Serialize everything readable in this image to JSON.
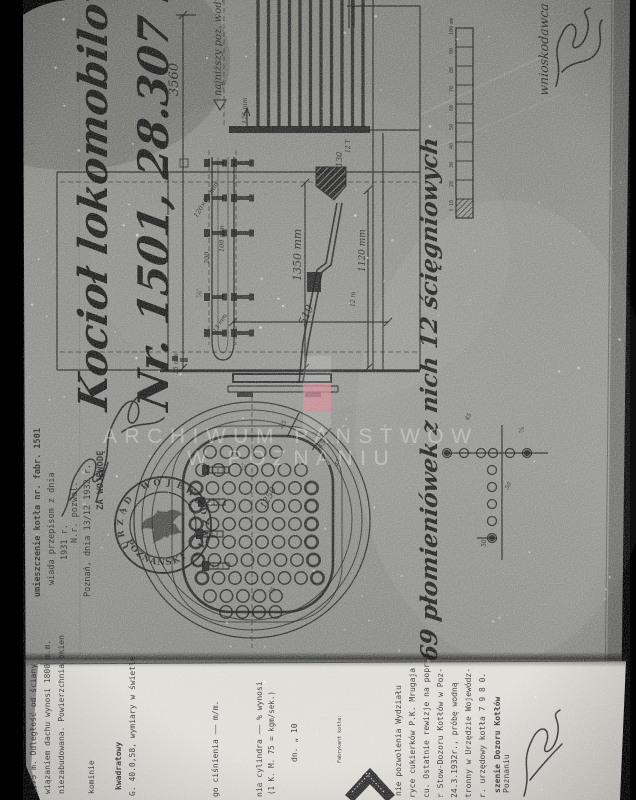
{
  "document": {
    "kind": "scanned archival boiler drawing",
    "language": "Polish",
    "title_line1": "Kocioł lokomobilowy z wycię",
    "title_line2": "Nr. 1501, 28.307 m² pow",
    "tube_note": "69 płomieniówek z nich 12 ścięgniowych",
    "applicant_label": "wnioskodawca",
    "watermark_line1": "ARCHIWUM PAŃSTWOW",
    "watermark_line2": "W POZNANIU"
  },
  "colors": {
    "scanner_bg": "#000000",
    "paper_grey": "#8f8f8d",
    "paper_white": "#e2e0da",
    "ink": "#1d1d1d",
    "watermark_white": "#ffffff",
    "marker_pink": "#d9818d"
  },
  "side_view": {
    "tubes": {
      "count": 11,
      "x0": 258,
      "pitch": 10.5,
      "y_top": 0,
      "y_bottom": 127
    },
    "stay_bolt_rows": [
      163,
      198,
      233,
      297,
      333
    ],
    "labels": [
      [
        "3560",
        178,
        96,
        13
      ],
      [
        "najniższy poz. wody",
        221,
        96,
        10
      ],
      [
        "125 mm",
        247,
        124,
        6.5
      ],
      [
        "120×32 mm",
        197,
        218,
        6.5,
        -58
      ],
      [
        "100 mm",
        224,
        252,
        6.5
      ],
      [
        "200",
        209,
        264,
        6.5
      ],
      [
        "⅞″",
        202,
        298,
        7
      ],
      [
        "13 mm",
        216,
        333,
        6,
        -58
      ],
      [
        "15 mm",
        178,
        374,
        6
      ],
      [
        "1350 mm",
        301,
        281,
        11
      ],
      [
        "1120 mm",
        365,
        272,
        9
      ],
      [
        "519",
        305,
        326,
        11,
        -65
      ],
      [
        "130",
        342,
        167,
        8
      ],
      [
        "12 T",
        350,
        153,
        6
      ],
      [
        "12 m",
        355,
        307,
        6
      ]
    ]
  },
  "tube_sheet": {
    "hole_radius": 6.2,
    "pitch": 16.5,
    "rows": [
      {
        "y": 452,
        "x0": 210,
        "n": 5
      },
      {
        "y": 470,
        "x0": 202,
        "n": 7
      },
      {
        "y": 488,
        "x0": 196,
        "n": 8
      },
      {
        "y": 506,
        "x0": 196,
        "n": 8
      },
      {
        "y": 524,
        "x0": 196,
        "n": 8
      },
      {
        "y": 542,
        "x0": 196,
        "n": 8
      },
      {
        "y": 560,
        "x0": 198,
        "n": 8
      },
      {
        "y": 578,
        "x0": 202,
        "n": 8
      },
      {
        "y": 596,
        "x0": 210,
        "n": 5
      },
      {
        "y": 612,
        "x0": 226,
        "n": 4
      }
    ],
    "bolts": [
      [
        210,
        470
      ],
      [
        206,
        502
      ],
      [
        204,
        534
      ],
      [
        210,
        566
      ]
    ],
    "labels": [
      [
        "25",
        282,
        429,
        6.5,
        -55
      ],
      [
        "45",
        321,
        449,
        6.5,
        -55
      ],
      [
        "45",
        337,
        467,
        6,
        -55
      ],
      [
        "1250",
        265,
        509,
        9,
        -60
      ],
      [
        "75",
        272,
        595,
        6,
        -60
      ],
      [
        "⅞″",
        247,
        471,
        6
      ]
    ]
  },
  "pitch_detail": {
    "r": 4.5,
    "row_y": 453,
    "row_x": [
      447,
      464,
      481,
      493,
      510,
      527
    ],
    "col_x": 492,
    "col_y": [
      470,
      487,
      504,
      521,
      538
    ],
    "filled": [
      [
        447,
        453
      ],
      [
        527,
        453
      ],
      [
        492,
        538
      ]
    ],
    "labels": [
      [
        "45",
        468,
        421,
        6,
        -60
      ],
      [
        "50",
        508,
        490,
        6,
        -60
      ],
      [
        "50",
        486,
        547,
        6,
        -90
      ],
      [
        "⅞",
        524,
        433,
        6,
        -90
      ]
    ]
  },
  "scale_bar": {
    "x": 456,
    "width": 17,
    "y_bottom": 218,
    "y_top": 28,
    "segments": 10,
    "unit": "mm",
    "tick_labels": [
      "10",
      "20",
      "30",
      "40",
      "50",
      "60",
      "70",
      "80",
      "90",
      "100"
    ],
    "half_label": "5"
  },
  "stamp": {
    "text_top": "URZĄD WOJEWÓDZKI",
    "text_bottom": "POZNAŃSKI",
    "separator": "*",
    "emblem": "eagle"
  },
  "approval_block": {
    "lines": [
      {
        "x": 40,
        "y": 597,
        "t": "umieszczenie kotła nr. fabr. 1501",
        "s": 8.5,
        "b": 1
      },
      {
        "x": 54,
        "y": 585,
        "t": "wiada przepisom z dnia",
        "s": 8.5
      },
      {
        "x": 67,
        "y": 560,
        "t": "1931 r.",
        "s": 8.5
      },
      {
        "x": 77,
        "y": 543,
        "t": "N.r. pozwol.",
        "s": 8.5
      },
      {
        "x": 90,
        "y": 597,
        "t": "Poznań, dnia 13/12 1932 r.",
        "s": 8.5
      },
      {
        "x": 103,
        "y": 510,
        "t": "ZA WOJEWODĘ",
        "s": 9,
        "b": 1
      }
    ]
  },
  "form": {
    "lines": [
      {
        "x": 36,
        "y": 794,
        "t": "3,75 m. Odległość od ściany",
        "s": 8
      },
      {
        "x": 50,
        "y": 794,
        "t": "wiązaniem dachu wynosi 1800 m.m.",
        "s": 8
      },
      {
        "x": 64,
        "y": 794,
        "t": "niezabudowana. Powierzchnia okien",
        "s": 8
      },
      {
        "x": 94,
        "y": 794,
        "t": "kominie",
        "s": 8
      },
      {
        "x": 121,
        "y": 790,
        "t": "kwadratowy",
        "s": 8,
        "b": 1
      },
      {
        "x": 135,
        "y": 796,
        "t": "G. 40.0,58, wymiary w świetle",
        "s": 8
      },
      {
        "x": 218,
        "y": 797,
        "t": "go ciśnienia —— m/m.",
        "s": 8
      },
      {
        "x": 262,
        "y": 797,
        "t": "nia cylindra —— % wynosi",
        "s": 8
      },
      {
        "x": 274,
        "y": 795,
        "t": "(1 K. M. 75 = kgm/sek.)",
        "s": 7.5
      },
      {
        "x": 297,
        "y": 762,
        "t": "dn. „ 10",
        "s": 8
      },
      {
        "x": 341,
        "y": 763,
        "t": "Fabrykant kotła:",
        "s": 5
      },
      {
        "x": 401,
        "y": 796,
        "t": "nie pozwolenia Wydziału",
        "s": 8
      },
      {
        "x": 415,
        "y": 798,
        "t": "ryce cukierków P.K. Mrugaja",
        "s": 8
      },
      {
        "x": 429,
        "y": 798,
        "t": "cu. Ostatnie rewizje na poprze",
        "s": 8
      },
      {
        "x": 443,
        "y": 798,
        "t": "r Stow-Dozoru Kotłów w Poz-",
        "s": 8
      },
      {
        "x": 457,
        "y": 798,
        "t": "24.3.1932r., próbę wodną",
        "s": 8
      },
      {
        "x": 471,
        "y": 798,
        "t": "tronny w Urzędzie Wojewódz-",
        "s": 8
      },
      {
        "x": 485,
        "y": 798,
        "t": "r. urzędowy kotła 7 9 8 0.",
        "s": 8
      },
      {
        "x": 500,
        "y": 793,
        "t": "szenie Dozoru Kotłów",
        "s": 8,
        "b": 1
      },
      {
        "x": 509,
        "y": 793,
        "t": "Poznaniu",
        "s": 8
      }
    ]
  }
}
